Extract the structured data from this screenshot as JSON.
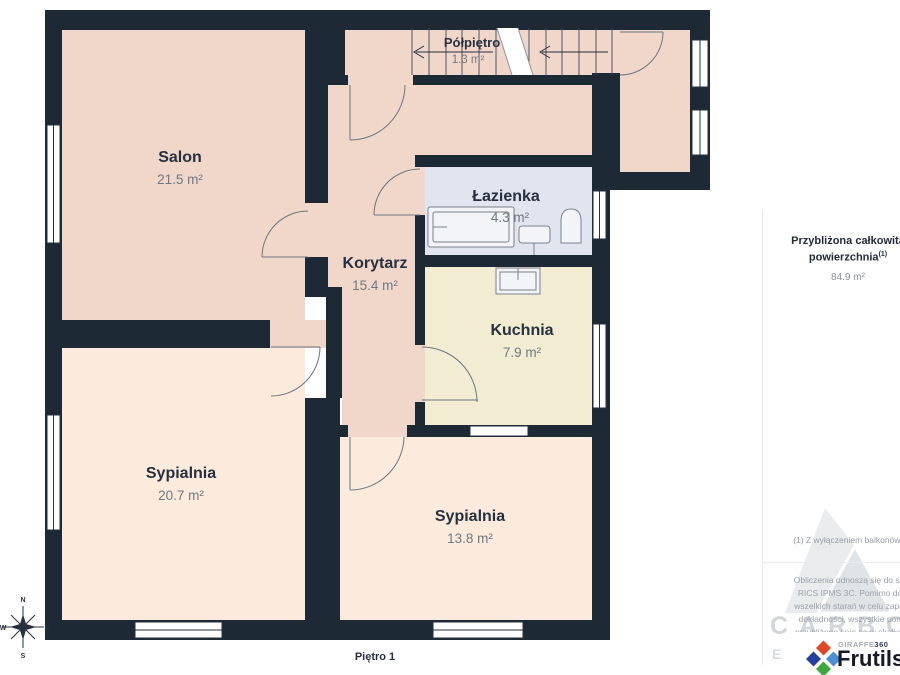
{
  "floor_label": "Piętro 1",
  "rooms": {
    "salon": {
      "name": "Salon",
      "area": "21.5 m²"
    },
    "polpietro": {
      "name": "Półpiętro",
      "area": "1.3 m²"
    },
    "lazienka": {
      "name": "Łazienka",
      "area": "4.3 m²"
    },
    "korytarz": {
      "name": "Korytarz",
      "area": "15.4 m²"
    },
    "kuchnia": {
      "name": "Kuchnia",
      "area": "7.9 m²"
    },
    "sypialnia1": {
      "name": "Sypialnia",
      "area": "20.7 m²"
    },
    "sypialnia2": {
      "name": "Sypialnia",
      "area": "13.8 m²"
    }
  },
  "summary": {
    "label_line1": "Przybliżona całkowita",
    "label_line2": "powierzchnia",
    "footnote_marker": "(1)",
    "value": "84.9 m²"
  },
  "footnote": "(1) Z wyłączeniem balkonów i tarasów",
  "disclaimer_lines": [
    "Obliczenia odnoszą się do standardu",
    "RICS IPMS 3C. Pomimo dołożenia",
    "wszelkich starań w celu zapewnienia",
    "dokładności, wszystkie pomiary są",
    "przybliżone i nie są w skali. Ten plan",
    "piętra ma charakter poglądowy."
  ],
  "compass": {
    "north": "N",
    "east": "E",
    "south": "S",
    "west": "W"
  },
  "watermark": {
    "line1": "CARBON",
    "line2": "ESTATE"
  },
  "branding": {
    "giraffe": "GIRAFFE",
    "g360": "360",
    "name": "Frutils"
  },
  "colors": {
    "wall": "#1e2936",
    "room_pink": "#f1d7ca",
    "room_cream": "#fcebdd",
    "kitchen": "#f2ecd3",
    "bathroom": "#e0e5ef",
    "accent_navy": "#26303f",
    "diamond_red": "#e04726",
    "diamond_navy": "#24409e",
    "diamond_blue": "#4a8fd2",
    "diamond_green": "#3fa73c"
  }
}
